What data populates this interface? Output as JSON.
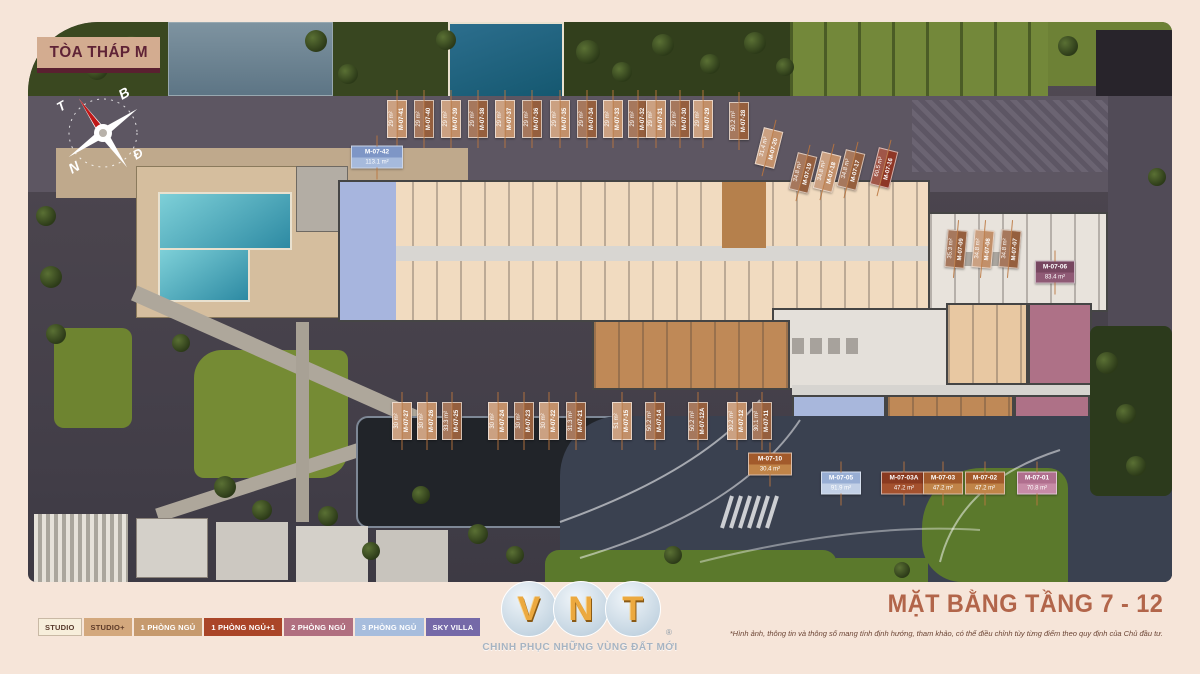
{
  "title": "TÒA THÁP M",
  "plan_title": "MẶT BẰNG TẦNG 7 - 12",
  "disclaimer": "*Hình ảnh, thông tin và thông số mang tính định hướng, tham khảo, có thể điều chỉnh tùy từng điểm theo quy định của Chủ đầu tư.",
  "compass": {
    "b": "B",
    "t": "T",
    "d": "Đ",
    "n": "N"
  },
  "logo": {
    "letters": "VNT",
    "reg": "®",
    "slogan": "CHINH PHỤC NHỮNG VÙNG ĐẤT MỚI"
  },
  "legend": [
    {
      "label": "STUDIO",
      "bg": "#f7eedb",
      "fg": "#57392b",
      "border": "#c9b9a5"
    },
    {
      "label": "STUDIO+",
      "bg": "#d3a87d",
      "fg": "#5d3a28",
      "border": "#d3a87d"
    },
    {
      "label": "1 PHÒNG NGỦ",
      "bg": "#c69a6e",
      "fg": "#ffffff",
      "border": "#c69a6e"
    },
    {
      "label": "1 PHÒNG NGỦ+1",
      "bg": "#aa4528",
      "fg": "#ffffff",
      "border": "#aa4528"
    },
    {
      "label": "2 PHÒNG NGỦ",
      "bg": "#b06f80",
      "fg": "#ffffff",
      "border": "#b06f80"
    },
    {
      "label": "3 PHÒNG NGỦ",
      "bg": "#a7bddd",
      "fg": "#ffffff",
      "border": "#a7bddd"
    },
    {
      "label": "SKY VILLA",
      "bg": "#7569a8",
      "fg": "#ffffff",
      "border": "#7569a8"
    }
  ],
  "label_colors": {
    "tan": {
      "bg": "#c2906a",
      "bg2": "#d2a57f"
    },
    "brown": {
      "bg": "#955f3e",
      "bg2": "#aa7250"
    },
    "red": {
      "bg": "#8e3626",
      "bg2": "#a34633"
    },
    "blue": {
      "bg": "#7e96c6",
      "bg2": "#a6badc"
    },
    "lightblue": {
      "bg": "#98aed4",
      "bg2": "#c2d0e6"
    },
    "purple": {
      "bg": "#774760",
      "bg2": "#8f5a75"
    },
    "pink": {
      "bg": "#b06f8e",
      "bg2": "#c78ba6"
    },
    "orange": {
      "bg": "#a25a2b",
      "bg2": "#c08448"
    },
    "rust": {
      "bg": "#8a3a20",
      "bg2": "#a4512e"
    }
  },
  "units": [
    {
      "code": "M-07-41",
      "area": "29 m²",
      "x": 397,
      "y": 119,
      "o": "v",
      "c": "tan"
    },
    {
      "code": "M-07-40",
      "area": "29 m²",
      "x": 424,
      "y": 119,
      "o": "v",
      "c": "brown"
    },
    {
      "code": "M-07-39",
      "area": "29 m²",
      "x": 451,
      "y": 119,
      "o": "v",
      "c": "tan"
    },
    {
      "code": "M-07-38",
      "area": "29 m²",
      "x": 478,
      "y": 119,
      "o": "v",
      "c": "brown"
    },
    {
      "code": "M-07-37",
      "area": "29 m²",
      "x": 505,
      "y": 119,
      "o": "v",
      "c": "tan"
    },
    {
      "code": "M-07-36",
      "area": "29 m²",
      "x": 532,
      "y": 119,
      "o": "v",
      "c": "brown"
    },
    {
      "code": "M-07-35",
      "area": "29 m²",
      "x": 560,
      "y": 119,
      "o": "v",
      "c": "tan"
    },
    {
      "code": "M-07-34",
      "area": "29 m²",
      "x": 587,
      "y": 119,
      "o": "v",
      "c": "brown"
    },
    {
      "code": "M-07-33",
      "area": "29 m²",
      "x": 613,
      "y": 119,
      "o": "v",
      "c": "tan"
    },
    {
      "code": "M-07-32",
      "area": "29 m²",
      "x": 638,
      "y": 119,
      "o": "v",
      "c": "brown"
    },
    {
      "code": "M-07-31",
      "area": "29 m²",
      "x": 656,
      "y": 119,
      "o": "v",
      "c": "tan"
    },
    {
      "code": "M-07-30",
      "area": "29 m²",
      "x": 680,
      "y": 119,
      "o": "v",
      "c": "brown"
    },
    {
      "code": "M-07-29",
      "area": "29 m²",
      "x": 703,
      "y": 119,
      "o": "v",
      "c": "tan"
    },
    {
      "code": "M-07-28",
      "area": "50.2 m²",
      "x": 739,
      "y": 121,
      "o": "v",
      "c": "brown"
    },
    {
      "code": "M-07-20",
      "area": "31.4 m²",
      "x": 769,
      "y": 148,
      "o": "v",
      "r": 14,
      "c": "tan"
    },
    {
      "code": "M-07-19",
      "area": "34.8 m²",
      "x": 803,
      "y": 173,
      "o": "v",
      "r": 14,
      "c": "brown"
    },
    {
      "code": "M-07-18",
      "area": "34.8 m²",
      "x": 827,
      "y": 172,
      "o": "v",
      "r": 14,
      "c": "tan"
    },
    {
      "code": "M-07-17",
      "area": "34.8 m²",
      "x": 851,
      "y": 170,
      "o": "v",
      "r": 14,
      "c": "brown"
    },
    {
      "code": "M-07-16",
      "area": "60.5 m²",
      "x": 884,
      "y": 168,
      "o": "v",
      "r": 14,
      "c": "red"
    },
    {
      "code": "M-07-09",
      "area": "35.3 m²",
      "x": 956,
      "y": 249,
      "o": "v",
      "r": 5,
      "c": "brown"
    },
    {
      "code": "M-07-08",
      "area": "34.8 m²",
      "x": 983,
      "y": 249,
      "o": "v",
      "r": 5,
      "c": "tan"
    },
    {
      "code": "M-07-07",
      "area": "34.8 m²",
      "x": 1010,
      "y": 249,
      "o": "v",
      "r": 5,
      "c": "brown"
    },
    {
      "code": "M-07-06",
      "area": "83.4 m²",
      "x": 1055,
      "y": 272,
      "o": "h",
      "w": 40,
      "c": "purple"
    },
    {
      "code": "M-07-42",
      "area": "113.1 m²",
      "x": 377,
      "y": 157,
      "o": "h",
      "w": 52,
      "c": "blue"
    },
    {
      "code": "M-07-27",
      "area": "30 m²",
      "x": 402,
      "y": 421,
      "o": "v",
      "c": "tan"
    },
    {
      "code": "M-07-26",
      "area": "30 m²",
      "x": 427,
      "y": 421,
      "o": "v",
      "c": "tan"
    },
    {
      "code": "M-07-25",
      "area": "33.3 m²",
      "x": 452,
      "y": 421,
      "o": "v",
      "c": "brown"
    },
    {
      "code": "M-07-24",
      "area": "30 m²",
      "x": 498,
      "y": 421,
      "o": "v",
      "c": "tan"
    },
    {
      "code": "M-07-23",
      "area": "30 m²",
      "x": 524,
      "y": 421,
      "o": "v",
      "c": "brown"
    },
    {
      "code": "M-07-22",
      "area": "30 m²",
      "x": 549,
      "y": 421,
      "o": "v",
      "c": "tan"
    },
    {
      "code": "M-07-21",
      "area": "31.3 m²",
      "x": 576,
      "y": 421,
      "o": "v",
      "c": "brown"
    },
    {
      "code": "M-07-15",
      "area": "51 m²",
      "x": 622,
      "y": 421,
      "o": "v",
      "c": "tan"
    },
    {
      "code": "M-07-14",
      "area": "50.2 m²",
      "x": 655,
      "y": 421,
      "o": "v",
      "c": "brown"
    },
    {
      "code": "M-07-12A",
      "area": "50.2 m²",
      "x": 698,
      "y": 421,
      "o": "v",
      "c": "brown"
    },
    {
      "code": "M-07-12",
      "area": "30.2 m²",
      "x": 737,
      "y": 421,
      "o": "v",
      "c": "tan"
    },
    {
      "code": "M-07-11",
      "area": "30.1 m²",
      "x": 762,
      "y": 421,
      "o": "v",
      "c": "brown"
    },
    {
      "code": "M-07-10",
      "area": "30.4 m²",
      "x": 770,
      "y": 464,
      "o": "h",
      "w": 44,
      "c": "orange"
    },
    {
      "code": "M-07-05",
      "area": "91.9 m²",
      "x": 841,
      "y": 483,
      "o": "h",
      "w": 40,
      "c": "lightblue"
    },
    {
      "code": "M-07-03A",
      "area": "47.2 m²",
      "x": 904,
      "y": 483,
      "o": "h",
      "w": 46,
      "c": "rust"
    },
    {
      "code": "M-07-03",
      "area": "47.2 m²",
      "x": 943,
      "y": 483,
      "o": "h",
      "w": 40,
      "c": "orange"
    },
    {
      "code": "M-07-02",
      "area": "47.2 m²",
      "x": 985,
      "y": 483,
      "o": "h",
      "w": 40,
      "c": "orange"
    },
    {
      "code": "M-07-01",
      "area": "70.8 m²",
      "x": 1037,
      "y": 483,
      "o": "h",
      "w": 40,
      "c": "pink"
    }
  ]
}
